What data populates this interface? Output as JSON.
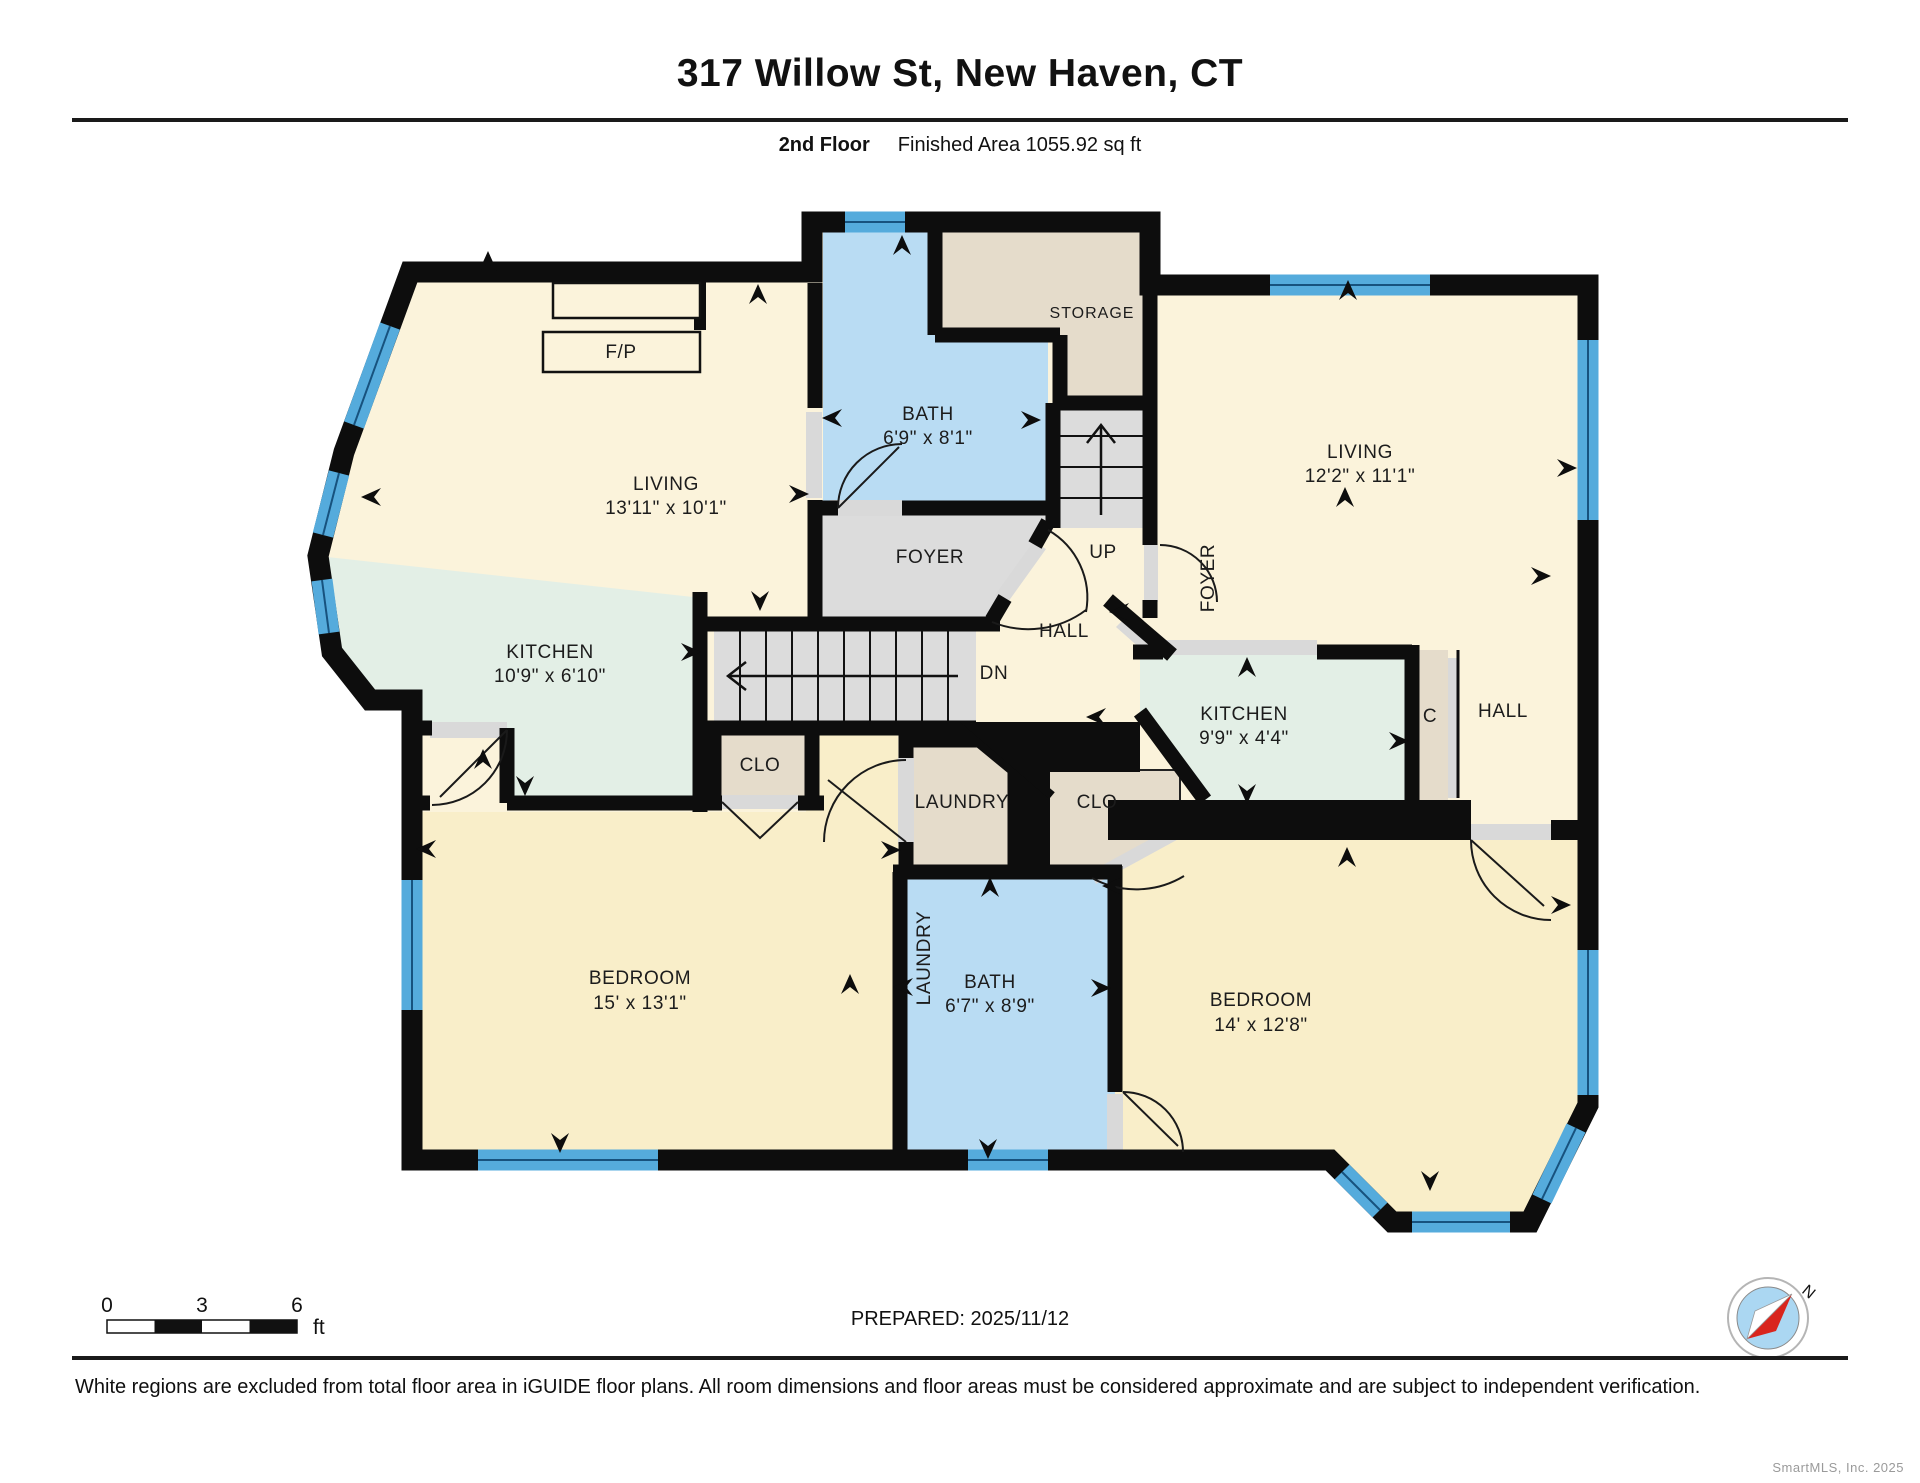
{
  "header": {
    "title": "317 Willow St, New Haven, CT",
    "floor_label": "2nd Floor",
    "area_label": "Finished Area 1055.92 sq ft"
  },
  "rooms": {
    "living1": {
      "name": "LIVING",
      "dims": "13'11\" x 10'1\""
    },
    "kitchen1": {
      "name": "KITCHEN",
      "dims": "10'9\" x 6'10\""
    },
    "bath1": {
      "name": "BATH",
      "dims": "6'9\" x 8'1\""
    },
    "storage": {
      "name": "STORAGE"
    },
    "foyer1": {
      "name": "FOYER"
    },
    "up": {
      "name": "UP"
    },
    "hall_center": {
      "name": "HALL"
    },
    "dn": {
      "name": "DN"
    },
    "foyer2": {
      "name": "FOYER"
    },
    "living2": {
      "name": "LIVING",
      "dims": "12'2\" x 11'1\""
    },
    "kitchen2": {
      "name": "KITCHEN",
      "dims": "9'9\" x 4'4\""
    },
    "closet_c": {
      "name": "C"
    },
    "hall_right": {
      "name": "HALL"
    },
    "clo1": {
      "name": "CLO"
    },
    "laundry1": {
      "name": "LAUNDRY"
    },
    "clo2": {
      "name": "CLO"
    },
    "laundry2": {
      "name": "LAUNDRY"
    },
    "bath2": {
      "name": "BATH",
      "dims": "6'7\" x 8'9\""
    },
    "bedroom1": {
      "name": "BEDROOM",
      "dims": "15' x 13'1\""
    },
    "bedroom2": {
      "name": "BEDROOM",
      "dims": "14' x 12'8\""
    },
    "fp": {
      "name": "F/P"
    }
  },
  "scale_bar": {
    "tick0": "0",
    "tick3": "3",
    "tick6": "6",
    "unit": "ft"
  },
  "compass": {
    "north_label": "N"
  },
  "footer": {
    "prepared": "PREPARED: 2025/11/12",
    "disclaimer": "White regions are excluded from total floor area in iGUIDE floor plans. All room dimensions and floor areas must be considered approximate and are subject to independent verification.",
    "watermark": "SmartMLS, Inc. 2025"
  },
  "colors": {
    "wall": "#0d0d0d",
    "room_cream": "#FBF3DB",
    "bedroom_cream": "#F9EEC9",
    "bath_blue": "#B9DCF3",
    "kitchen_mint": "#E3EFE6",
    "closet_tan": "#E5DCCB",
    "stair_gray": "#DCDCDC",
    "window_blue": "#55ABDC"
  }
}
